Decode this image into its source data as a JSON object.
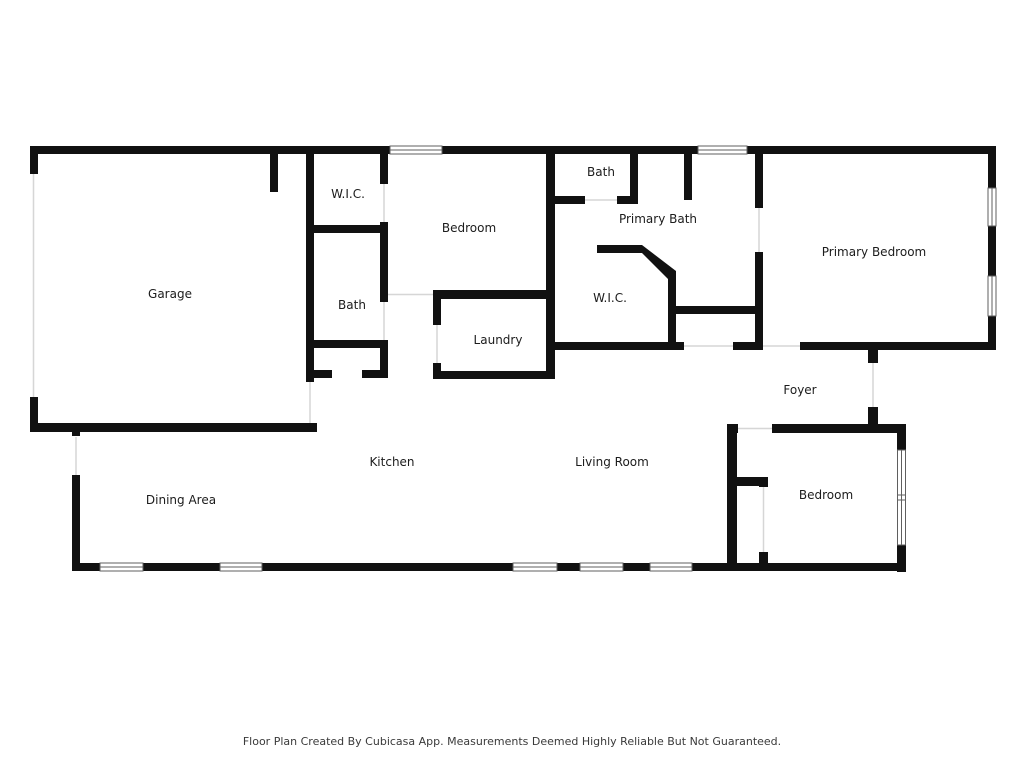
{
  "footer": {
    "disclaimer": "Floor Plan Created By Cubicasa App. Measurements Deemed Highly Reliable But Not Guaranteed."
  },
  "rooms": {
    "garage": "Garage",
    "wic_hall": "W.I.C.",
    "bath_hall": "Bath",
    "bedroom_front": "Bedroom",
    "laundry": "Laundry",
    "bath_top": "Bath",
    "primary_bath": "Primary Bath",
    "wic_primary": "W.I.C.",
    "primary_bedroom": "Primary Bedroom",
    "foyer": "Foyer",
    "dining_area": "Dining Area",
    "kitchen": "Kitchen",
    "living_room": "Living Room",
    "bedroom_rear": "Bedroom"
  },
  "colors": {
    "wall": "#111111",
    "window_frame": "#5f5f5f",
    "door_line": "#d6d6d6",
    "background": "#ffffff",
    "label_text": "#1c1c1c"
  }
}
